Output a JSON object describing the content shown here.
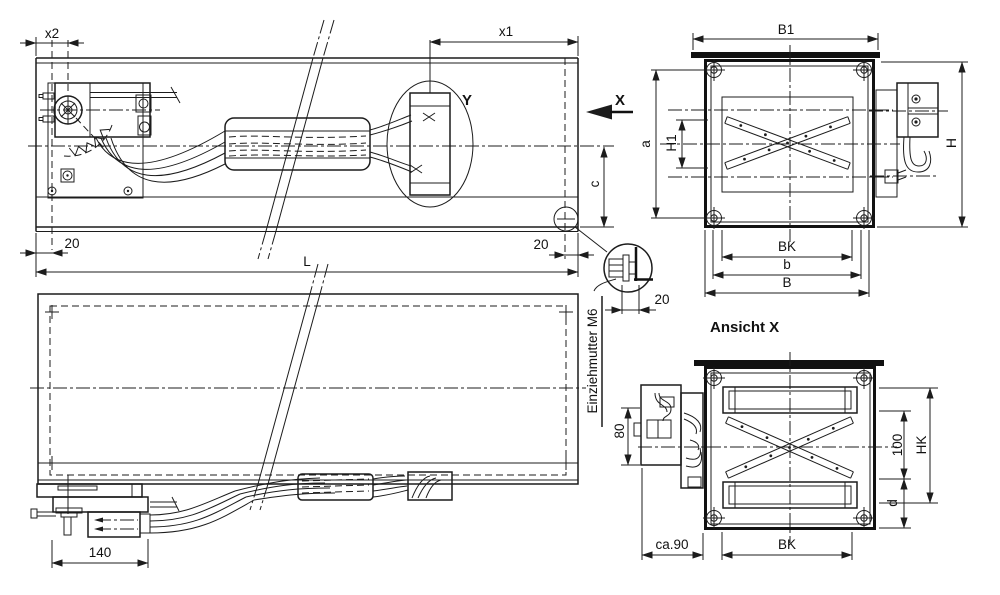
{
  "drawing": {
    "side_view": {
      "x2": "x2",
      "x1": "x1",
      "offset_left": "20",
      "offset_right": "20",
      "length": "L",
      "center_offset": "c",
      "detail_y": "Y",
      "view_direction": "X"
    },
    "front_view": {
      "flange_width": "B1",
      "height": "H",
      "screw_spacing_v": "a",
      "blade_zone_height": "H1",
      "inner_width": "BK",
      "screw_spacing_h": "b",
      "width": "B"
    },
    "plan_view": {
      "actuator_length": "140"
    },
    "view_x": {
      "title": "Ansicht X",
      "actuator_offset": "80",
      "depth": "ca.90",
      "inner_width": "BK",
      "shaft_spacing": "100",
      "inner_height": "HK",
      "bottom_offset": "d"
    },
    "detail": {
      "note": "Einziehmutter M6",
      "offset": "20"
    },
    "colors": {
      "ink": "#1c1c1c",
      "paper": "#ffffff"
    }
  }
}
